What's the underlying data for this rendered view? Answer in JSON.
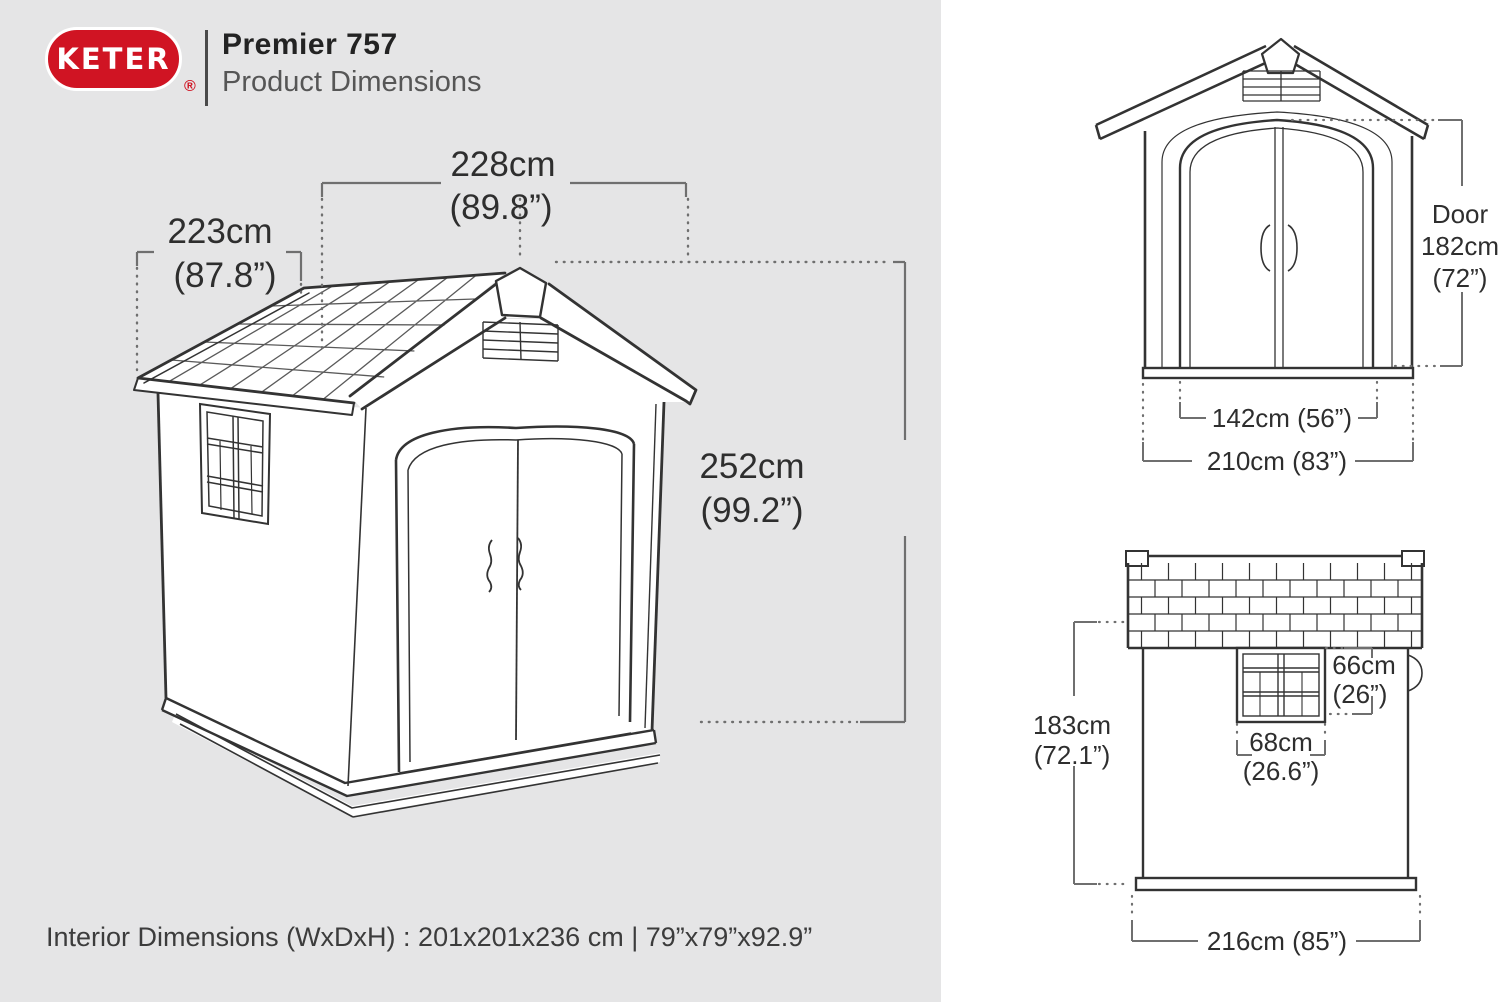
{
  "header": {
    "logo_text": "KETER",
    "registered_mark": "®",
    "title": "Premier 757",
    "subtitle": "Product Dimensions"
  },
  "iso_view": {
    "width_cm": "228cm",
    "width_in": "(89.8”)",
    "depth_cm": "223cm",
    "depth_in": "(87.8”)",
    "height_cm": "252cm",
    "height_in": "(99.2”)"
  },
  "front_view": {
    "door_word": "Door",
    "door_height_cm": "182cm",
    "door_height_in": "(72”)",
    "door_width": "142cm (56”)",
    "overall_width": "210cm (83”)"
  },
  "side_view": {
    "height_cm": "183cm",
    "height_in": "(72.1”)",
    "window_height_cm": "66cm",
    "window_height_in": "(26”)",
    "window_width_cm": "68cm",
    "window_width_in": "(26.6”)",
    "overall_depth": "216cm (85”)"
  },
  "footer": {
    "interior_note": "Interior Dimensions (WxDxH) : 201x201x236 cm | 79”x79”x92.9”"
  },
  "colors": {
    "brand_red": "#d01423",
    "left_panel_bg": "#e5e5e6",
    "right_panel_bg": "#ffffff",
    "drawing_line": "#333333",
    "dimension_line": "#6f6f6f",
    "text": "#2e2e2e"
  }
}
